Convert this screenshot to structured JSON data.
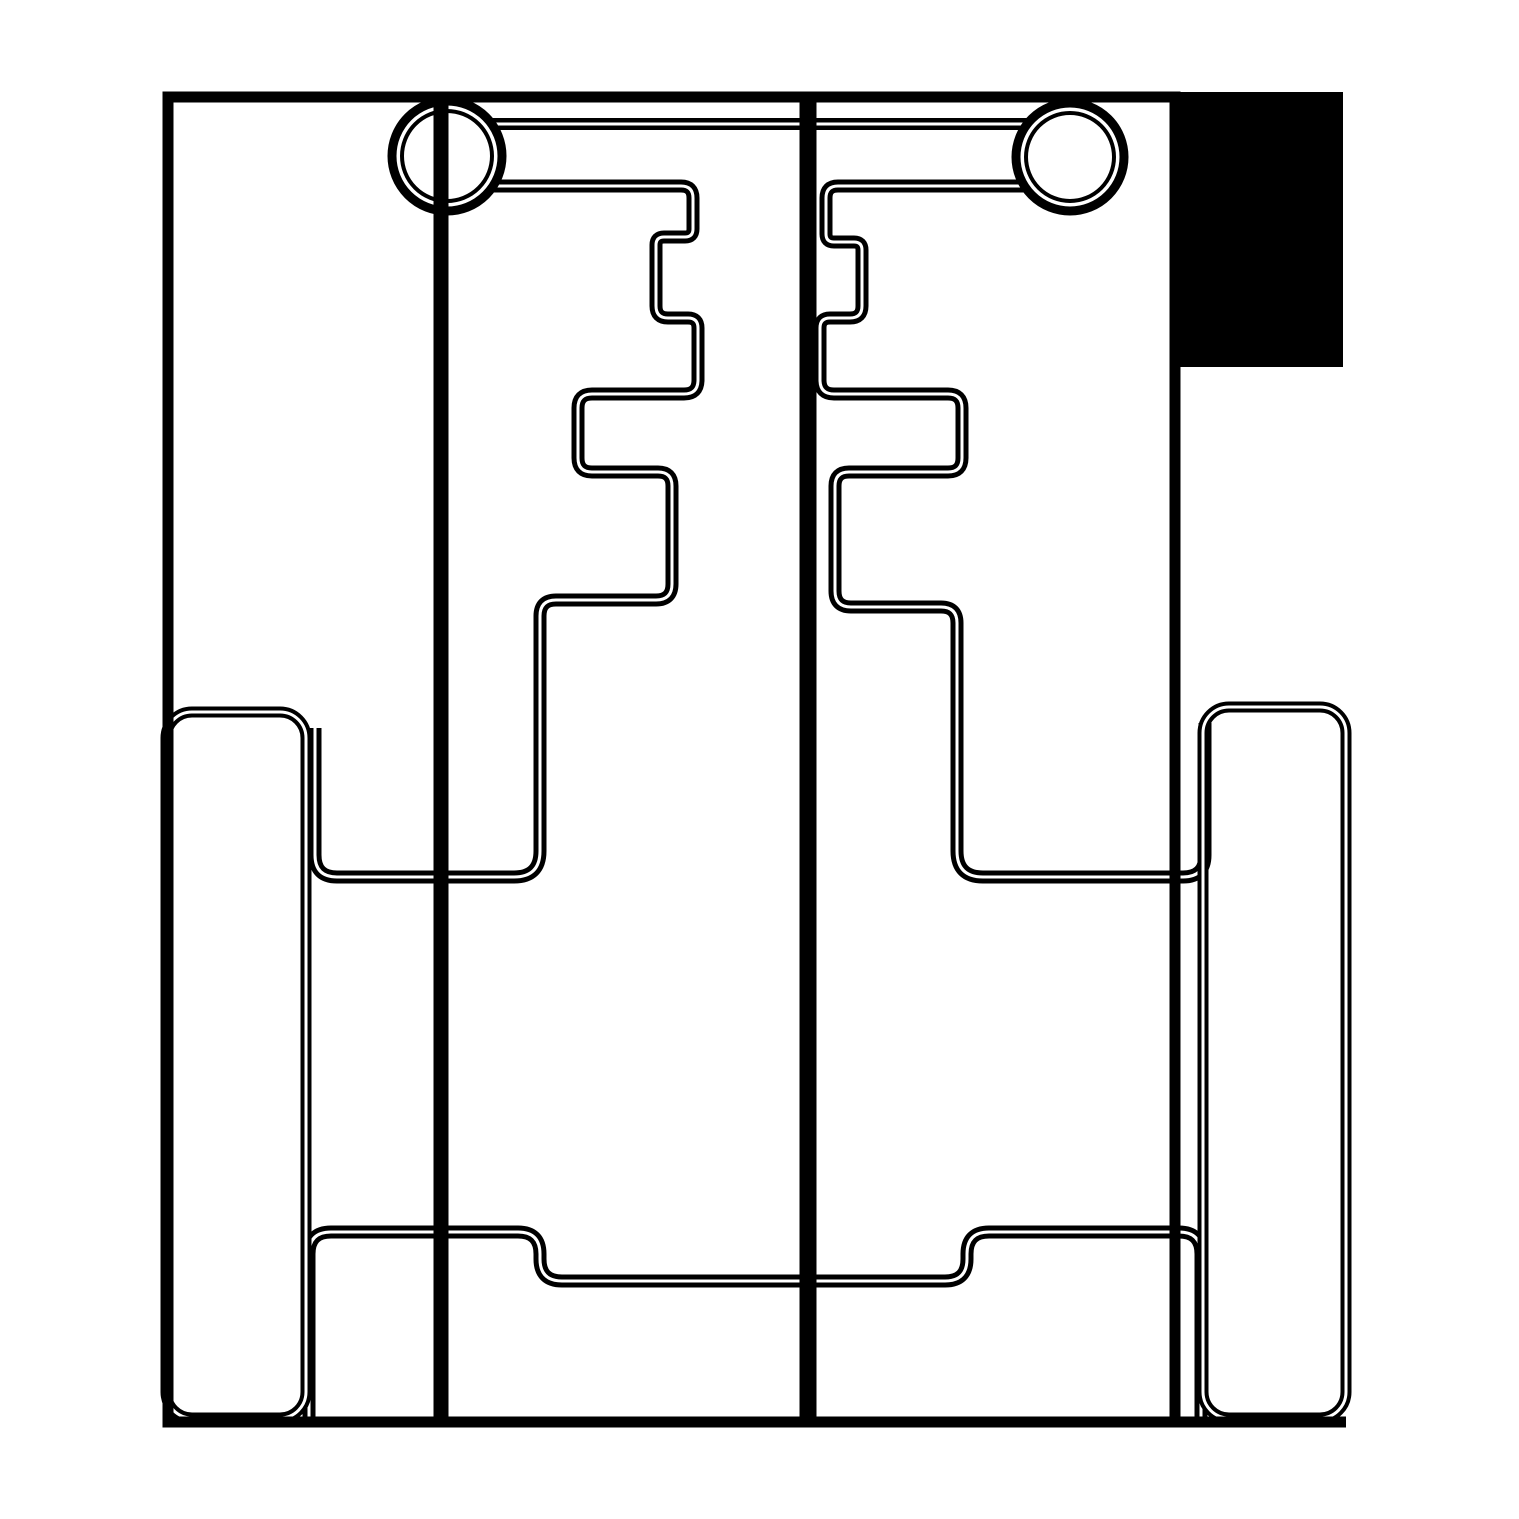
{
  "canvas": {
    "width": 1519,
    "height": 1519,
    "background": "#ffffff",
    "line_color": "#000000",
    "core_color": "#ffffff",
    "core_width": 3
  },
  "drawing": {
    "kind": "technical-line-drawing",
    "elements": [
      {
        "type": "fill-rect",
        "name": "solid-block-top-right",
        "x": 1170,
        "y": 92,
        "w": 173,
        "h": 275
      },
      {
        "type": "line",
        "name": "link-bar-top-edge",
        "x1": 447,
        "y1": 124,
        "x2": 1070,
        "y2": 124,
        "w": 12,
        "double": true
      },
      {
        "type": "path",
        "name": "left-half-contour",
        "w": 13,
        "double": true,
        "d": "M 447 186 L 681 186 Q 693 186 693 198 L 693 229 Q 693 237 685 237 L 664 237 Q 656 237 656 245 L 656 306 Q 656 318 668 318 L 688 318 Q 698 318 698 328 L 698 380 Q 698 394 684 394 L 592 394 Q 578 394 578 408 L 578 458 Q 578 472 592 472 L 658 472 Q 672 472 672 486 L 672 584 Q 672 600 656 600 L 556 600 Q 540 600 540 616 L 540 851 Q 540 877 514 877 L 337 877 Q 315 877 315 855 L 315 728"
      },
      {
        "type": "path",
        "name": "left-bottom-step-contour",
        "w": 13,
        "double": true,
        "d": "M 309 1418 L 309 1254 Q 309 1232 331 1232 L 518 1232 Q 540 1232 540 1254 L 540 1259 Q 540 1281 562 1281 L 817 1281"
      },
      {
        "type": "path",
        "name": "right-half-contour",
        "w": 13,
        "double": true,
        "d": "M 1070 186 L 838 186 Q 826 186 826 198 L 826 234 Q 826 242 834 242 L 854 242 Q 862 242 862 250 L 862 306 Q 862 318 850 318 L 830 318 Q 820 318 820 328 L 820 380 Q 820 394 834 394 L 948 394 Q 962 394 962 408 L 962 458 Q 962 472 948 472 L 849 472 Q 835 472 835 486 L 835 591 Q 835 607 851 607 L 941 607 Q 957 607 957 623 L 957 851 Q 957 877 983 877 L 1183 877 Q 1205 877 1205 855 L 1205 723"
      },
      {
        "type": "path",
        "name": "right-bottom-step-contour",
        "w": 13,
        "double": true,
        "d": "M 1201 1418 L 1201 1254 Q 1201 1232 1179 1232 L 989 1232 Q 967 1232 967 1254 L 967 1259 Q 967 1281 945 1281 L 803 1281"
      },
      {
        "type": "ring",
        "name": "left-pin-outer-ring",
        "cx": 447,
        "cy": 156,
        "r": 55,
        "w": 9,
        "fill": "#ffffff"
      },
      {
        "type": "ring",
        "name": "left-pin-inner-ring",
        "cx": 447,
        "cy": 156,
        "r": 45,
        "w": 4,
        "fill": "none"
      },
      {
        "type": "ring",
        "name": "right-pin-outer-ring",
        "cx": 1070,
        "cy": 157,
        "r": 54,
        "w": 9,
        "fill": "#ffffff"
      },
      {
        "type": "ring",
        "name": "right-pin-inner-ring",
        "cx": 1070,
        "cy": 157,
        "r": 44,
        "w": 4,
        "fill": "none"
      },
      {
        "type": "line",
        "name": "left-pin-axis-line",
        "x1": 441,
        "y1": 97,
        "x2": 441,
        "y2": 1422,
        "w": 15
      },
      {
        "type": "line",
        "name": "center-parting-line",
        "x1": 808,
        "y1": 97,
        "x2": 808,
        "y2": 1422,
        "w": 17
      },
      {
        "type": "round-rect",
        "name": "left-foot-block",
        "x": 166,
        "y": 712,
        "w": 140,
        "h": 706,
        "rx": 26,
        "sw": 11,
        "double": true
      },
      {
        "type": "round-rect",
        "name": "right-foot-block",
        "x": 1203,
        "y": 707,
        "w": 143,
        "h": 711,
        "rx": 26,
        "sw": 11,
        "double": true
      },
      {
        "type": "round-rect",
        "name": "outer-frame",
        "x": 168,
        "y": 97,
        "w": 1007,
        "h": 1325,
        "rx": 0,
        "sw": 11,
        "double": false
      },
      {
        "type": "line",
        "name": "base-line",
        "x1": 163,
        "y1": 1422,
        "x2": 1346,
        "y2": 1422,
        "w": 11
      }
    ]
  }
}
